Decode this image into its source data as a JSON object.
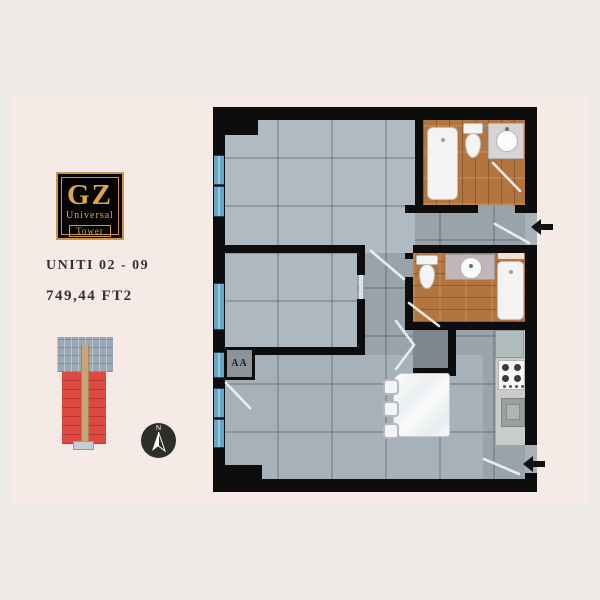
{
  "branding": {
    "logo_top": "GZ",
    "logo_mid": "Universal",
    "logo_bottom": "Tower",
    "gold": "#d9a64c",
    "logo_bg": "#070503"
  },
  "unit_info": {
    "unit_label": "UNITI 02 - 09",
    "area_label": "749,44  FT2"
  },
  "compass": {
    "north_label": "N"
  },
  "floorplan": {
    "section_marker": "AA",
    "icons": {
      "entry_arrow": "left-black-arrow",
      "compass_needle": "north-needle"
    },
    "colors": {
      "wall": "#0d0d0d",
      "tile_light": "#afbac2",
      "tile_dark": "#99a3aa",
      "wood": "#b2753f",
      "window_glass": "#66a7c8",
      "marble": "#f4f6f7",
      "highlight_red": "#dc4a43",
      "corridor_tan": "#c9a478",
      "background_inner": "#f5eae5",
      "background_outer": "#ece9e6"
    }
  }
}
